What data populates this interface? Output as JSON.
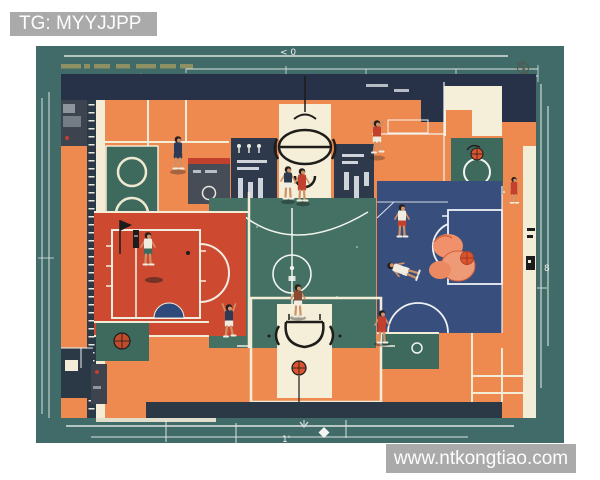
{
  "watermarks": {
    "top_left": "TG: MYYJJPP",
    "bottom_right": "www.ntkongtiao.com"
  },
  "blueprint": {
    "subject": "basketball court floor plan illustration",
    "dimension_labels": {
      "top": "< 0",
      "right": "8",
      "bottom": "1'"
    },
    "icons": [
      "basketball-icon",
      "hoop-top-icon",
      "hoop-bottom-icon",
      "compass-icon",
      "person-circle-icon",
      "flag-icon",
      "player-figure",
      "diamond-marker"
    ],
    "colors": {
      "canvas_teal": "#416b69",
      "court_orange": "#ee8a50",
      "key_red": "#cd4a31",
      "key_blue": "#384f7d",
      "court_green": "#447163",
      "panel_teal": "#3e6a5d",
      "panel_navy": "#273248",
      "strip_navy": "#2b3845",
      "line_cream": "#f3ecd6",
      "line_white": "#f2f4ef",
      "ball_orange": "#d9542f",
      "salmon": "#f0916c",
      "annotation_olive": "#8e8f62",
      "watermark_gray": "#a7a7a7"
    }
  }
}
